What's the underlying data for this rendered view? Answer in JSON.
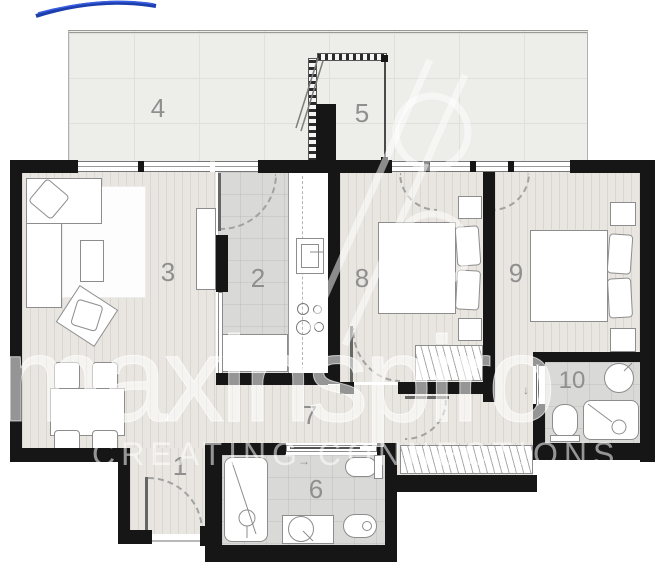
{
  "brand": {
    "watermark_text": "maxinspiro",
    "watermark_tagline": "CREATING CONNECTIONS",
    "logo_color": "#2a4bd4"
  },
  "floor_plan": {
    "rooms": [
      {
        "number": "1"
      },
      {
        "number": "2"
      },
      {
        "number": "3"
      },
      {
        "number": "4"
      },
      {
        "number": "5"
      },
      {
        "number": "6"
      },
      {
        "number": "7"
      },
      {
        "number": "8"
      },
      {
        "number": "9"
      },
      {
        "number": "10"
      }
    ],
    "annotations": {
      "slide_right_arrow": "→",
      "slide_down_arrow": "↓"
    },
    "colors": {
      "wall": "#161616",
      "wood_floor": "#e9e6e1",
      "tile_floor": "#d9d9d8",
      "terrace_floor": "#ededea",
      "room_label": "#8f8f8f",
      "watermark": "rgba(255,255,255,0.55)"
    }
  }
}
